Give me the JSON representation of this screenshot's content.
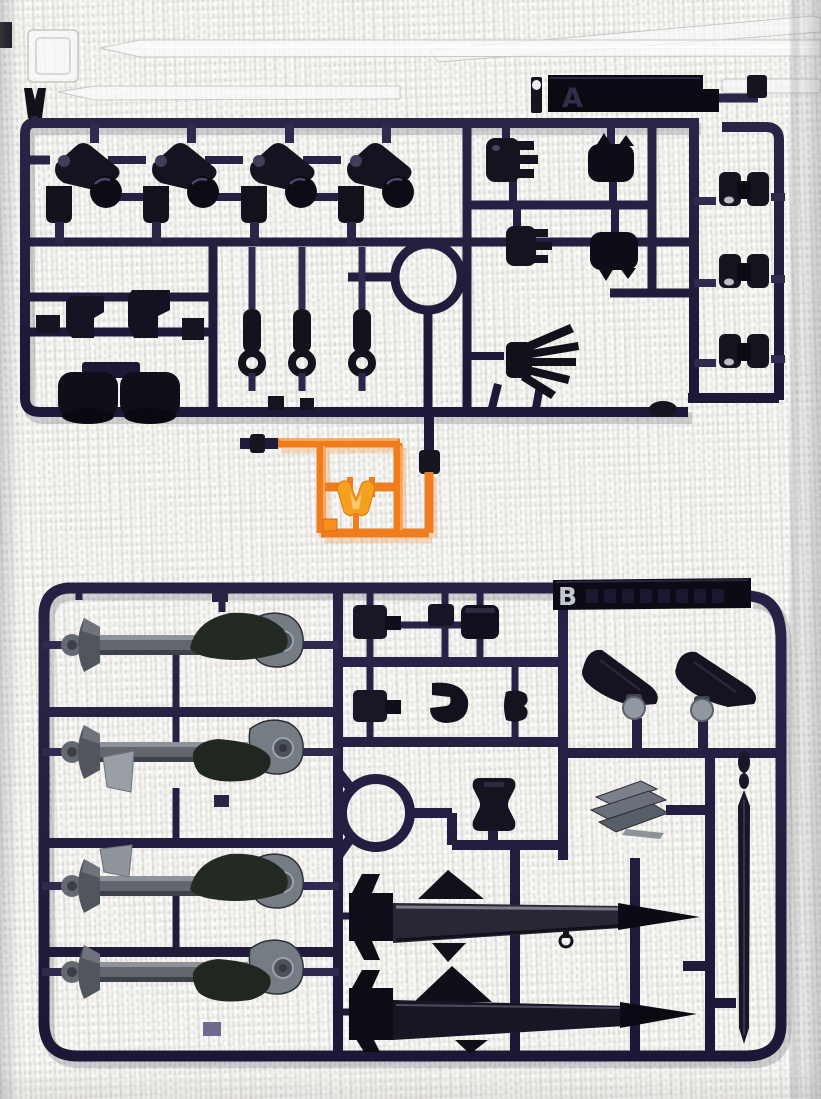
{
  "photo": {
    "subject": "model-kit-runner-sprues-on-textured-cloth",
    "background_hex": "#e9e7e3"
  },
  "sprues": {
    "a": {
      "label": "A",
      "plastic_hex": "#241e3c"
    },
    "b": {
      "label": "B",
      "plastic_hex": "#241e3c"
    },
    "orange": {
      "plastic_hex": "#ef7d1d"
    },
    "clear": {
      "plastic_hex": "#f5f5f5"
    }
  }
}
